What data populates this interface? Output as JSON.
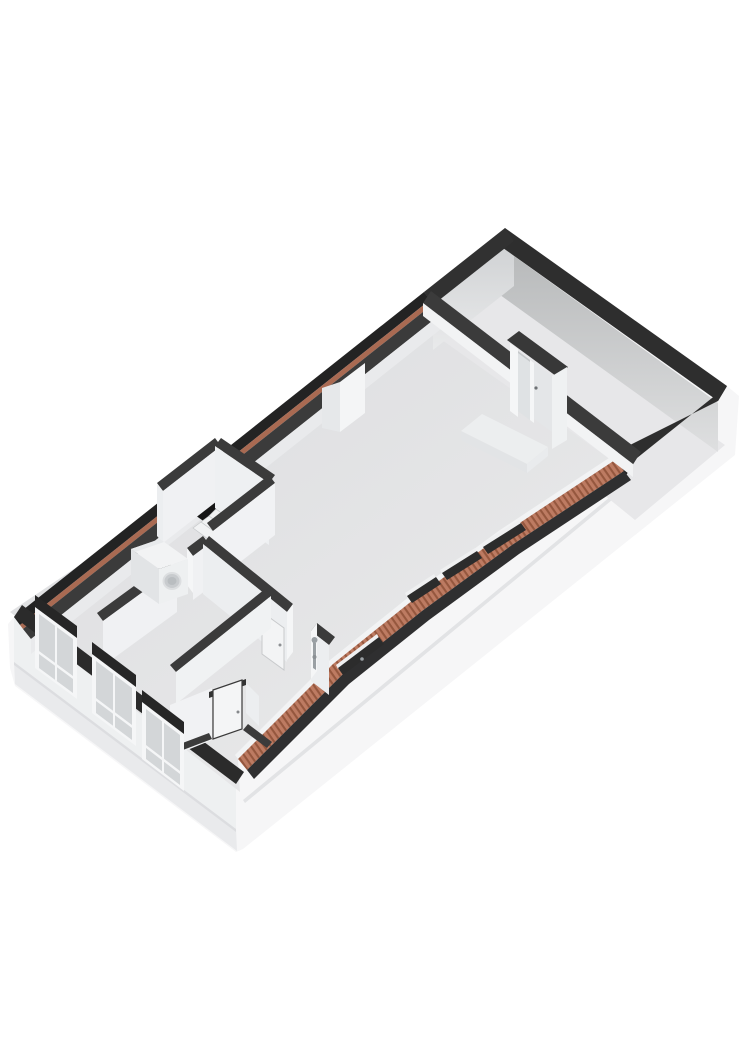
{
  "scene": {
    "title": "3D floor plan - attic storey, axonometric view",
    "type": "floorplan-3d",
    "background": "#ffffff"
  },
  "colors": {
    "bg": "#ffffff",
    "hull": "#f6f6f7",
    "swFace": "#eef0f1",
    "swPlinth": "#e9eaec",
    "plinthLine": "#e2e3e5",
    "floorMainDark": "#dcdddf",
    "floorMainLight": "#ebebec",
    "floorNE": "#e7e7e9",
    "bandOuter": "#232323",
    "bandNE": "#2e2e2e",
    "bandSW": "#2b2b2b",
    "bandInterior": "#3b3b3b",
    "orangeLine": "#a96a52",
    "hatchBase": "#bd7b62",
    "hatchStripe": "#95573e",
    "faceLit": "#f3f4f5",
    "faceShade": "#e7e9ea",
    "faceNEDark": "#b6b8b9",
    "faceNELight": "#dedfe0",
    "faceNWDark": "#cfd1d3",
    "faceNWLight": "#e9eaeb",
    "glass": "#dfe2e4",
    "frameWhite": "#f5f6f7",
    "stairHole": "#161616",
    "tread": "#f1f2f3",
    "treadEdge": "#c7c9cb",
    "roofWindow": "#2c2c2c",
    "metal": "#9aa0a4",
    "washerTop": "#f2f3f4",
    "washerSide": "#e2e4e6",
    "washerFace": "#eef0f1",
    "washerDrum": "#c8cbce",
    "washerDrumInner": "#b9bdc0"
  },
  "rooms": [
    {
      "name": "ne-room"
    },
    {
      "name": "living-area"
    },
    {
      "name": "landing"
    },
    {
      "name": "stairwell"
    },
    {
      "name": "laundry-area"
    },
    {
      "name": "bedroom"
    },
    {
      "name": "bathroom"
    },
    {
      "name": "toilet"
    }
  ],
  "objects": [
    {
      "name": "washing-machine",
      "count": 1
    },
    {
      "name": "staircase",
      "count": 1
    },
    {
      "name": "french-doors",
      "count": 1
    },
    {
      "name": "bathroom-door",
      "count": 1
    },
    {
      "name": "toilet-door",
      "count": 1
    },
    {
      "name": "shower",
      "count": 1
    },
    {
      "name": "chimney-breast",
      "count": 1
    },
    {
      "name": "roof-windows",
      "count": 4
    },
    {
      "name": "dormer-windows",
      "count": 3
    }
  ]
}
